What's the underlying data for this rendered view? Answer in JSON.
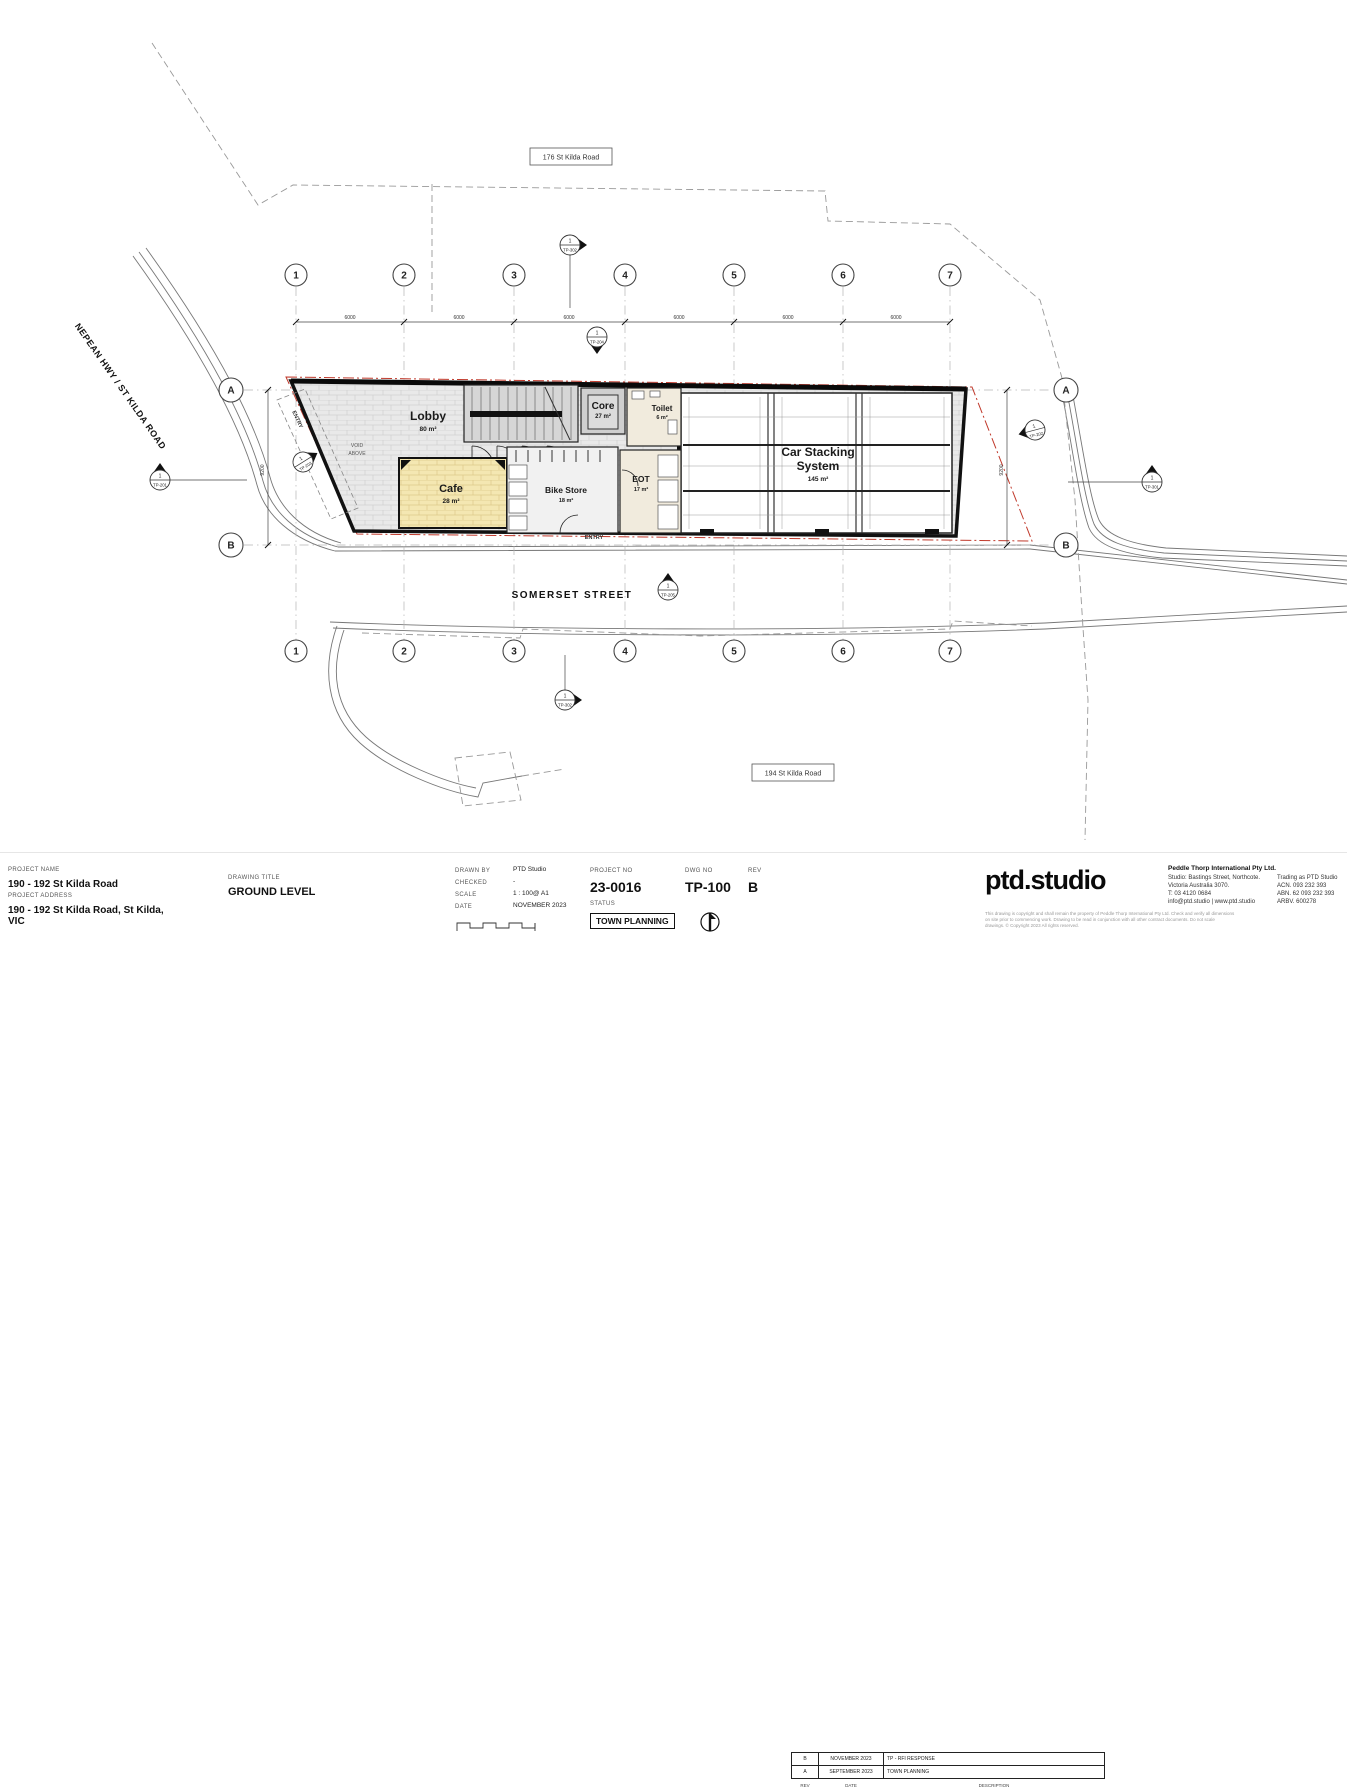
{
  "colors": {
    "red_boundary": "#c0392b",
    "cafe_fill": "#f4e7b2",
    "lobby_fill": "#e9e9e9"
  },
  "plan": {
    "streets": {
      "nepean": "NEPEAN HWY / ST KILDA ROAD",
      "somerset": "SOMERSET STREET"
    },
    "lots": {
      "north": "176 St Kilda Road",
      "south": "194 St Kilda Road"
    },
    "rooms": {
      "lobby": {
        "name": "Lobby",
        "area": "80 m²"
      },
      "core": {
        "name": "Core",
        "area": "27 m²"
      },
      "toilet": {
        "name": "Toilet",
        "area": "6 m²"
      },
      "cafe": {
        "name": "Cafe",
        "area": "28 m²"
      },
      "bike": {
        "name": "Bike Store",
        "area": "18 m²"
      },
      "eot": {
        "name": "EOT",
        "area": "17 m²"
      },
      "car": {
        "line1": "Car Stacking",
        "line2": "System",
        "area": "145 m²"
      }
    },
    "annotations": {
      "void1": "VOID",
      "void2": "ABOVE",
      "entry": "ENTRY"
    },
    "grid": {
      "cols": [
        "1",
        "2",
        "3",
        "4",
        "5",
        "6",
        "7"
      ],
      "rows": [
        "A",
        "B"
      ]
    },
    "dims": {
      "bay": "6000",
      "depth": "9200"
    },
    "markers": {
      "num": "1",
      "top": "TP-302",
      "top_dim": "TP-204",
      "left": "TP-201",
      "entry_diag": "TP-203",
      "right_diag": "TP-202",
      "right": "TP-301",
      "somerset": "TP-205",
      "bottom": "TP-302"
    }
  },
  "titleblock": {
    "labels": {
      "project_name": "PROJECT NAME",
      "project_address": "PROJECT ADDRESS",
      "drawing_title": "DRAWING TITLE",
      "drawn_by": "DRAWN BY",
      "checked": "CHECKED",
      "scale": "SCALE",
      "date": "DATE",
      "project_no": "PROJECT NO",
      "status": "STATUS",
      "dwg_no": "DWG NO",
      "rev": "REV"
    },
    "project_name": "190 - 192 St Kilda Road",
    "project_address": "190 - 192 St Kilda Road, St Kilda, VIC",
    "drawing_title": "GROUND LEVEL",
    "drawn_by": "PTD Studio",
    "checked": "-",
    "scale": "1 : 100@ A1",
    "date": "NOVEMBER 2023",
    "project_no": "23-0016",
    "status": "TOWN PLANNING",
    "dwg_no": "TP-100",
    "rev": "B",
    "revisions": [
      {
        "rev": "B",
        "date": "NOVEMBER 2023",
        "desc": "TP - RFI RESPONSE"
      },
      {
        "rev": "A",
        "date": "SEPTEMBER 2023",
        "desc": "TOWN PLANNING"
      }
    ],
    "rev_footer": {
      "rev": "REV",
      "date": "DATE",
      "desc": "DESCRIPTION"
    },
    "logo": "ptd.studio",
    "company": {
      "name": "Peddle Thorp International Pty Ltd.",
      "l1": "Studio: Bastings Street, Northcote.",
      "l2": "Victoria Australia 3070.",
      "l3": "T: 03 4120 0684",
      "l4": "info@ptd.studio  |  www.ptd.studio",
      "r1": "Trading as PTD Studio",
      "r2": "ACN. 093 232 393",
      "r3": "ABN. 62 093 232 393",
      "r4": "ARBV. 600278"
    },
    "disclaimer": "This drawing is copyright and shall remain the property of Peddle Thorp International Pty Ltd. Check and verify all dimensions on site prior to commencing work. Drawing to be read in conjunction with all other contract documents. Do not scale drawings. © Copyright 2023 All rights reserved."
  }
}
